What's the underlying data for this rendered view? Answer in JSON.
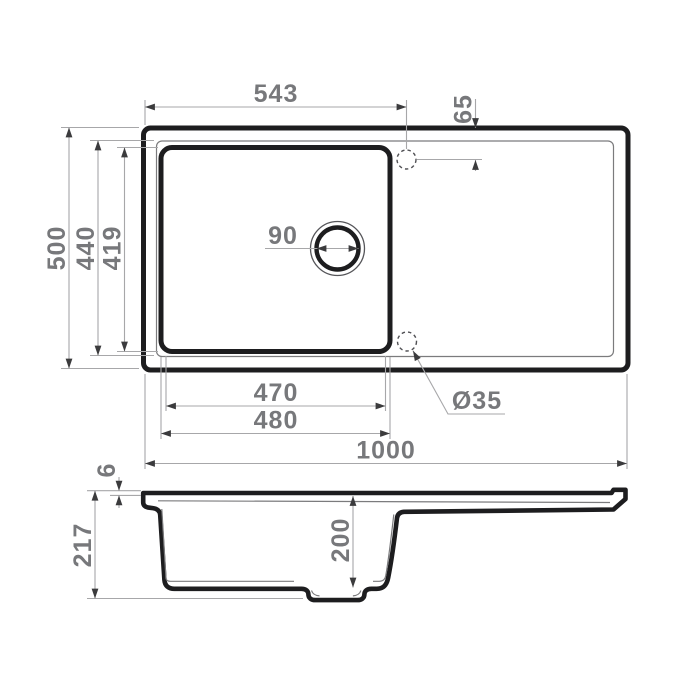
{
  "drawing": {
    "type": "sink-technical-drawing",
    "views": [
      "top-view",
      "side-section-view"
    ]
  },
  "dims": {
    "top_view": {
      "tap_offset_x": "543",
      "tap_offset_y": "65",
      "depth_overall": "500",
      "bowl_depth_outer": "440",
      "bowl_depth_inner": "419",
      "drain_diameter": "90",
      "bowl_width_inner": "470",
      "bowl_width_outer": "480",
      "width_overall": "1000",
      "tap_hole_diameter": "Ø35"
    },
    "side_view": {
      "rim_thickness": "6",
      "height_overall": "217",
      "bowl_depth": "200"
    }
  },
  "colors": {
    "part_line": "#1d1d1f",
    "thin_line": "#7b7b7d",
    "dimension_line": "#a7a7a9",
    "arrow": "#3b3b3d",
    "dimension_text": "#77787b",
    "background": "#ffffff"
  }
}
